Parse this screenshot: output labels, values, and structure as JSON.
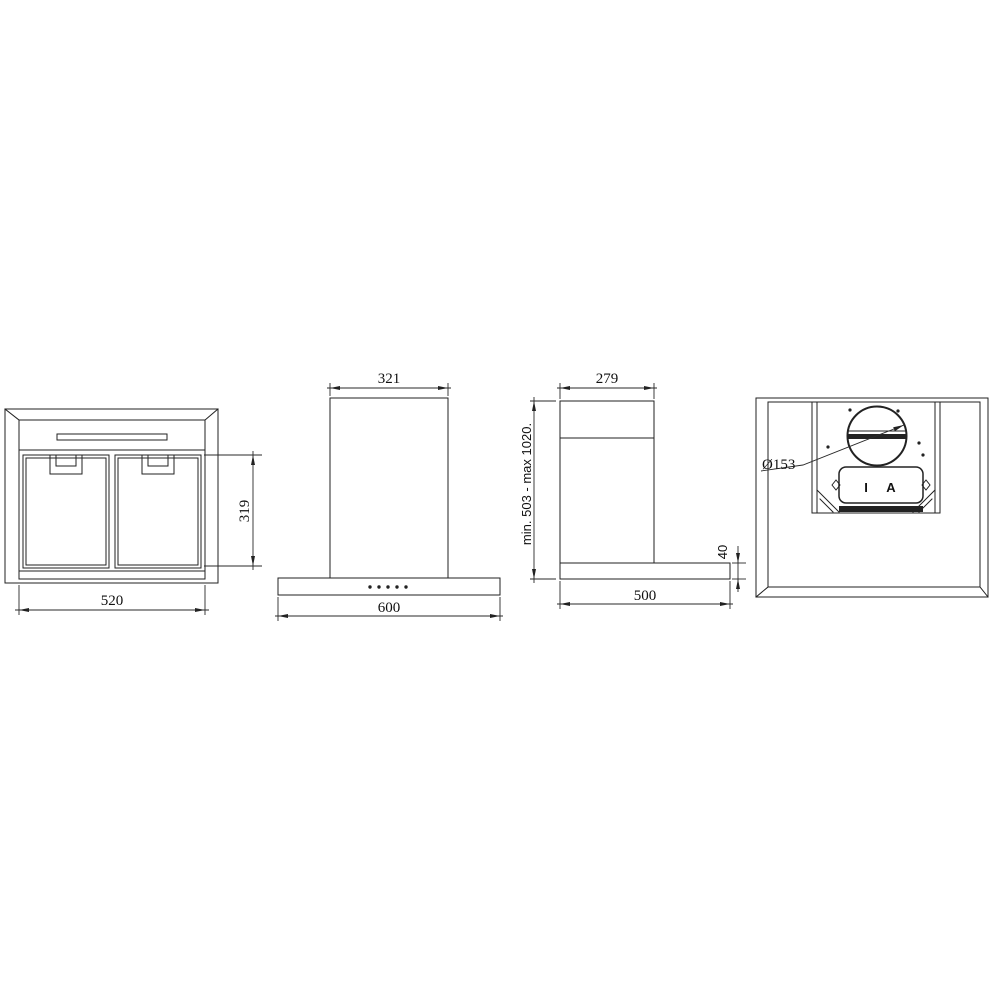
{
  "drawing": {
    "background_color": "#ffffff",
    "line_color": "#222222",
    "views": {
      "front_panel": {
        "width_mm": "520",
        "filter_height_mm": "319"
      },
      "front": {
        "chimney_width_mm": "321",
        "hood_width_mm": "600",
        "button_count": 5
      },
      "side": {
        "chimney_depth_mm": "279",
        "hood_depth_mm": "500",
        "body_height_mm": "40",
        "overall_height_range": "min. 503 - max 1020."
      },
      "bottom": {
        "outlet_diameter": "Ø153",
        "plate_mark_left": "I",
        "plate_mark_right": "A"
      }
    }
  }
}
